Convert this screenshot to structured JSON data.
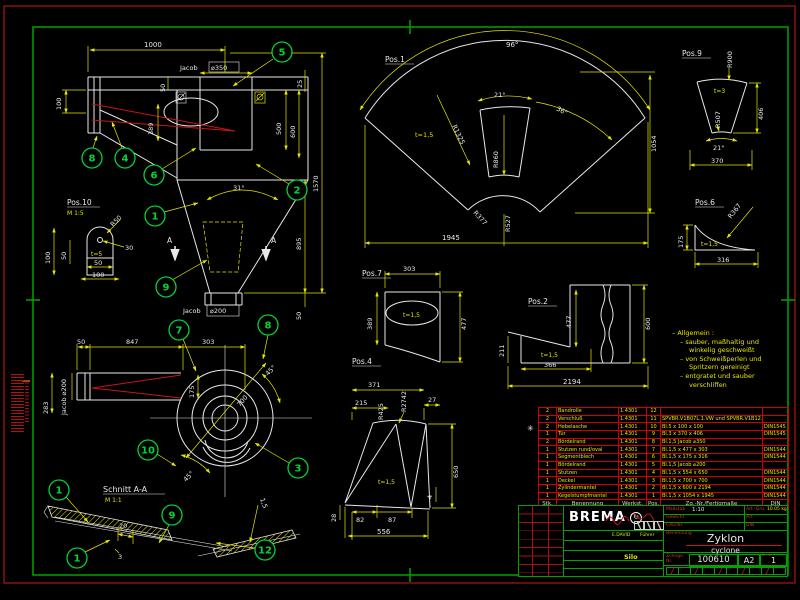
{
  "balloons": {
    "n5": "5",
    "n8a": "8",
    "n4": "4",
    "n6": "6",
    "n2": "2",
    "n1a": "1",
    "n9a": "9",
    "n7": "7",
    "n8b": "8",
    "n10": "10",
    "n3": "3",
    "n1b": "1",
    "n1c": "1",
    "n9b": "9",
    "n12": "12"
  },
  "front": {
    "dim_1000": "1000",
    "flange_top_brand": "Jacob",
    "flange_top_dia": "⌀350",
    "dim_50_top": "50",
    "dim_25": "25",
    "dim_100": "100",
    "dim_389": "389",
    "dim_500": "500",
    "dim_600": "600",
    "dim_1570": "1570",
    "angle_31": "31°",
    "dim_895": "895",
    "dim_50_bot": "50",
    "flange_bot_brand": "Jacob",
    "flange_bot_dia": "⌀200",
    "section_a_left": "A",
    "section_a_right": "A"
  },
  "pos10": {
    "label": "Pos.10",
    "scale": "M 1:5",
    "dim_100_v": "100",
    "dim_50_v": "50",
    "r50": "R50",
    "dim_30": "30",
    "t": "t=5",
    "dim_50_h": "50",
    "dim_100_h": "100"
  },
  "pos1": {
    "label": "Pos.1",
    "a96": "96°",
    "a21": "21°",
    "a36": "36°",
    "t": "t=1,5",
    "r1325": "R1325",
    "r860": "R860",
    "r377": "R377",
    "r527": "R527",
    "dim_1054": "1054",
    "dim_1945": "1945"
  },
  "pos9": {
    "label": "Pos.9",
    "r900": "R900",
    "t": "t=3",
    "r507": "R507",
    "dim_406": "406",
    "a21": "21°",
    "dim_370": "370"
  },
  "pos6": {
    "label": "Pos.6",
    "dim_175": "175",
    "r367": "R367",
    "t": "t=1,5",
    "dim_316": "316"
  },
  "pos7": {
    "label": "Pos.7",
    "dim_303": "303",
    "dim_389": "389",
    "dim_477": "477",
    "t": "t=1,5"
  },
  "pos2": {
    "label": "Pos.2",
    "dim_477": "477",
    "dim_600": "600",
    "dim_211": "211",
    "t": "t=1,5",
    "dim_366": "366",
    "dim_2194": "2194"
  },
  "pos4": {
    "label": "Pos.4",
    "dim_371": "371",
    "dim_215": "215",
    "r425": "R425",
    "r2742": "R2742",
    "dim_27": "27",
    "dim_650": "650",
    "dim_4": "4",
    "dim_82": "82",
    "dim_87": "87",
    "dim_556": "556",
    "dim_28": "28",
    "t": "t=1,5"
  },
  "top_view": {
    "dim_50": "50",
    "dim_847": "847",
    "dim_303": "303",
    "dim_175": "175",
    "dim_283": "283",
    "flange": "Jacob ⌀200",
    "dia_700": "700",
    "a45_1": "45°",
    "a45_2": "45°"
  },
  "section": {
    "title": "Schnitt A-A",
    "scale": "M 1:1",
    "dim_20": "20",
    "dim_3": "3",
    "dim_1_5": "1,5"
  },
  "notes": {
    "l1": "– Allgemein :",
    "l2": "– sauber, maßhaltig und",
    "l3": "winkelig geschweißt",
    "l4": "– von Schweißperlen und",
    "l5": "Spritzern gereinigt",
    "l6": "– entgratet und sauber",
    "l7": "verschliffen"
  },
  "parts_list": {
    "rev_mark": "✳",
    "headers": {
      "qty": "Stk.",
      "name": "Benennung",
      "material": "Werkst.",
      "pos": "Pos.",
      "size": "Zg.-Nr./Fertigmaße",
      "din": "DIN"
    },
    "rows": [
      {
        "qty": "2",
        "name": "Bandrolle",
        "material": "1.4301",
        "pos": "12",
        "size": "",
        "din": ""
      },
      {
        "qty": "2",
        "name": "Verschluß",
        "material": "1.4301",
        "pos": "11",
        "size": "SPVBR.V1B07L.1.VW und SPVBR.V1B12.1.VW",
        "din": ""
      },
      {
        "qty": "2",
        "name": "Hebelasche",
        "material": "1.4301",
        "pos": "10",
        "size": "Bl.5 x 100 x 100",
        "din": "DIN1545"
      },
      {
        "qty": "1",
        "name": "Tür",
        "material": "1.4301",
        "pos": "9",
        "size": "Bl.3 x 370 x 406",
        "din": "DIN1545"
      },
      {
        "qty": "2",
        "name": "Bördelrand",
        "material": "1.4301",
        "pos": "8",
        "size": "Bl.1,5 Jacob ⌀350",
        "din": ""
      },
      {
        "qty": "1",
        "name": "Stutzen rund/oval",
        "material": "1.4301",
        "pos": "7",
        "size": "Bl.1,5 x 477 x 303",
        "din": "DIN1544"
      },
      {
        "qty": "1",
        "name": "Segmentblech",
        "material": "1.4301",
        "pos": "6",
        "size": "Bl.1,5 x 175 x 316",
        "din": "DIN1544"
      },
      {
        "qty": "1",
        "name": "Bördelrand",
        "material": "1.4301",
        "pos": "5",
        "size": "Bl.1,5 Jacob ⌀200",
        "din": ""
      },
      {
        "qty": "1",
        "name": "Stutzen",
        "material": "1.4301",
        "pos": "4",
        "size": "Bl.1,5 x 554 x 650",
        "din": "DIN1544"
      },
      {
        "qty": "1",
        "name": "Deckel",
        "material": "1.4301",
        "pos": "3",
        "size": "Bl.1,5 x 700 x 700",
        "din": "DIN1544"
      },
      {
        "qty": "1",
        "name": "Zylindermantel",
        "material": "1.4301",
        "pos": "2",
        "size": "Bl.1,5 x 600 x 2194",
        "din": "DIN1544"
      },
      {
        "qty": "1",
        "name": "Kegelstumpfmantel",
        "material": "1.4301",
        "pos": "1",
        "size": "Bl.1,5 x 1054 x 1945",
        "din": "DIN1544"
      }
    ]
  },
  "title_block": {
    "company": "BREMA",
    "scale_label": "Maßstab",
    "scale_value": "1:10",
    "weight_label": "Gewicht",
    "art_group_label": "Art.-Gru.",
    "art_group_value": "10.05 kg",
    "art_label": "Art.",
    "cad_label": "CAD-Nr.",
    "din_label": "DIN.",
    "name_label": "Benennung",
    "title": "Zyklon",
    "subtitle": "cyclone",
    "drawing_label": "Zchngs-Nr.",
    "drawing_number": "100610",
    "format": "A2",
    "sheet_label": "Bl.-Nr.",
    "sheet_number": "1",
    "project": "Silo",
    "sig_date": "E.DAVID",
    "sig_name": "Führer"
  },
  "colors": {
    "line_white": "#e8e8e8",
    "dim_yellow": "#e6e600",
    "balloon_green": "#00d435",
    "frame_green": "#00a400",
    "accent_red": "#c81616",
    "table_red": "#d40000"
  }
}
